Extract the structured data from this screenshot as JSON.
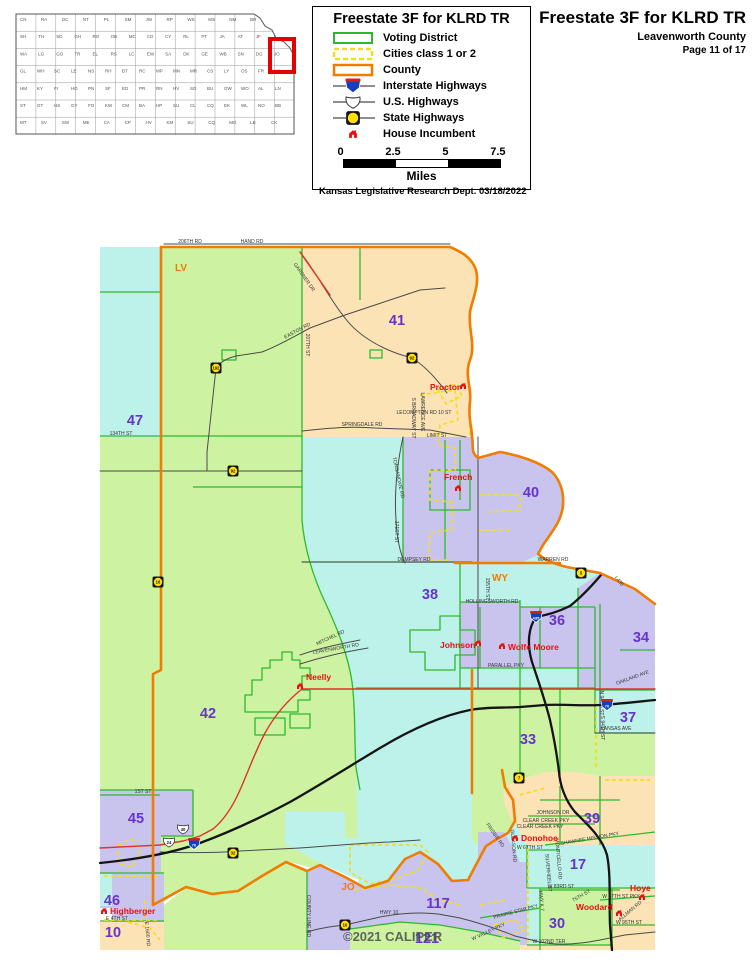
{
  "header": {
    "title": "Freestate 3F for KLRD TR",
    "county": "Leavenworth County",
    "page": "Page 11 of 17"
  },
  "legend": {
    "title": "Freestate 3F for KLRD TR",
    "items": [
      {
        "key": "voting",
        "label": "Voting District"
      },
      {
        "key": "cities",
        "label": "Cities class 1 or 2"
      },
      {
        "key": "county",
        "label": "County"
      },
      {
        "key": "interstate",
        "label": "Interstate Highways"
      },
      {
        "key": "us",
        "label": "U.S. Highways"
      },
      {
        "key": "state",
        "label": "State Highways"
      },
      {
        "key": "house",
        "label": "House Incumbent"
      }
    ],
    "scale": {
      "ticks": [
        "0",
        "2.5",
        "5",
        "7.5"
      ],
      "unit": "Miles"
    },
    "credit": "Kansas Legislative Research Dept. 03/18/2022"
  },
  "inset": {
    "name": "Kansas counties overview map",
    "highlight": "LV",
    "rows": [
      [
        "CN",
        "RA",
        "DC",
        "NT",
        "PL",
        "SM",
        "JW",
        "RP",
        "WS",
        "MS",
        "NM",
        "BR",
        "DP"
      ],
      [
        "SH",
        "TH",
        "SD",
        "GH",
        "RO",
        "OB",
        "MC",
        "CD",
        "CY",
        "RL",
        "PT",
        "JA",
        "AT",
        "JF",
        "LV"
      ],
      [
        "WA",
        "LG",
        "GO",
        "TR",
        "EL",
        "RS",
        "LC",
        "EW",
        "SA",
        "DK",
        "GE",
        "WB",
        "SN",
        "DG",
        "JO"
      ],
      [
        "GL",
        "WH",
        "SC",
        "LE",
        "NS",
        "RH",
        "BT",
        "RC",
        "MP",
        "MN",
        "MR",
        "CS",
        "LY",
        "OS",
        "FR",
        "MI"
      ],
      [
        "HM",
        "KY",
        "FI",
        "HG",
        "PN",
        "SF",
        "ED",
        "PR",
        "RN",
        "HV",
        "SG",
        "BU",
        "GW",
        "WO",
        "AL",
        "LN"
      ],
      [
        "ST",
        "GT",
        "HS",
        "GY",
        "FO",
        "KW",
        "CM",
        "BA",
        "HP",
        "SU",
        "CL",
        "CQ",
        "EK",
        "WL",
        "NO",
        "BB"
      ],
      [
        "MT",
        "SV",
        "SW",
        "ME",
        "CA",
        "CP",
        "HV",
        "KM",
        "SU",
        "CQ",
        "MG",
        "LB",
        "CK"
      ]
    ]
  },
  "map": {
    "copyright": {
      "t": "©2021 CALIPER",
      "x": 343,
      "y": 941
    },
    "county_labels": [
      {
        "t": "LV",
        "x": 181,
        "y": 271
      },
      {
        "t": "WY",
        "x": 500,
        "y": 581
      },
      {
        "t": "JO",
        "x": 348,
        "y": 890
      }
    ],
    "district_labels": [
      {
        "t": "41",
        "x": 397,
        "y": 325
      },
      {
        "t": "47",
        "x": 135,
        "y": 425
      },
      {
        "t": "40",
        "x": 531,
        "y": 497
      },
      {
        "t": "38",
        "x": 430,
        "y": 599
      },
      {
        "t": "36",
        "x": 557,
        "y": 625
      },
      {
        "t": "34",
        "x": 641,
        "y": 642
      },
      {
        "t": "37",
        "x": 628,
        "y": 722
      },
      {
        "t": "33",
        "x": 528,
        "y": 744
      },
      {
        "t": "42",
        "x": 208,
        "y": 718
      },
      {
        "t": "45",
        "x": 136,
        "y": 823
      },
      {
        "t": "39",
        "x": 592,
        "y": 823
      },
      {
        "t": "17",
        "x": 578,
        "y": 869
      },
      {
        "t": "46",
        "x": 112,
        "y": 905
      },
      {
        "t": "10",
        "x": 113,
        "y": 937
      },
      {
        "t": "30",
        "x": 557,
        "y": 928
      },
      {
        "t": "117",
        "x": 438,
        "y": 908
      },
      {
        "t": "121",
        "x": 427,
        "y": 943
      }
    ],
    "incumbents": [
      {
        "name": "Proctor",
        "x": 430,
        "y": 390,
        "hx": 463,
        "hy": 386
      },
      {
        "name": "French",
        "x": 444,
        "y": 480,
        "hx": 458,
        "hy": 488
      },
      {
        "name": "Johnson",
        "x": 440,
        "y": 648,
        "hx": 478,
        "hy": 643
      },
      {
        "name": "Wolfe Moore",
        "x": 508,
        "y": 650,
        "hx": 502,
        "hy": 646
      },
      {
        "name": "Neelly",
        "x": 306,
        "y": 680,
        "hx": 300,
        "hy": 686
      },
      {
        "name": "Highberger",
        "x": 110,
        "y": 914,
        "hx": 104,
        "hy": 911
      },
      {
        "name": "Donohoe",
        "x": 521,
        "y": 841,
        "hx": 515,
        "hy": 838
      },
      {
        "name": "Woodard",
        "x": 576,
        "y": 910,
        "hx": 619,
        "hy": 913
      },
      {
        "name": "Hoye",
        "x": 630,
        "y": 891,
        "hx": 642,
        "hy": 897
      }
    ],
    "shields": {
      "interstate": [
        {
          "n": "435",
          "x": 536,
          "y": 617
        },
        {
          "n": "70",
          "x": 607,
          "y": 705
        },
        {
          "n": "70",
          "x": 194,
          "y": 844
        }
      ],
      "us": [
        {
          "n": "40",
          "x": 183,
          "y": 829
        },
        {
          "n": "24",
          "x": 169,
          "y": 842
        }
      ],
      "state": [
        {
          "n": "192",
          "x": 216,
          "y": 368
        },
        {
          "n": "92",
          "x": 412,
          "y": 358
        },
        {
          "n": "92",
          "x": 233,
          "y": 471
        },
        {
          "n": "16",
          "x": 158,
          "y": 582
        },
        {
          "n": "5",
          "x": 581,
          "y": 573
        },
        {
          "n": "7",
          "x": 519,
          "y": 778
        },
        {
          "n": "32",
          "x": 233,
          "y": 853
        },
        {
          "n": "10",
          "x": 345,
          "y": 925
        }
      ]
    },
    "road_labels": [
      {
        "t": "206TH RD",
        "x": 190,
        "y": 243
      },
      {
        "t": "HAND RD",
        "x": 252,
        "y": 243
      },
      {
        "t": "GARDNER DR",
        "x": 303,
        "y": 278,
        "r": 55
      },
      {
        "t": "EASTON RD",
        "x": 298,
        "y": 332,
        "r": -28
      },
      {
        "t": "207TH ST",
        "x": 306,
        "y": 345,
        "r": 90
      },
      {
        "t": "SPRINGDALE RD",
        "x": 362,
        "y": 426
      },
      {
        "t": "134TH ST",
        "x": 121,
        "y": 435
      },
      {
        "t": "LECOMPTON RD 10 ST",
        "x": 424,
        "y": 414
      },
      {
        "t": "LIMIT ST",
        "x": 437,
        "y": 437
      },
      {
        "t": "S BROADWAY ST",
        "x": 412,
        "y": 418,
        "r": 90
      },
      {
        "t": "LAWRENCE AVE",
        "x": 421,
        "y": 412,
        "r": 90
      },
      {
        "t": "TONGANOXIE RD",
        "x": 397,
        "y": 478,
        "r": 78
      },
      {
        "t": "171ST ST",
        "x": 395,
        "y": 532,
        "r": 90
      },
      {
        "t": "DEMPSEY RD",
        "x": 414,
        "y": 561
      },
      {
        "t": "WARREN RD",
        "x": 553,
        "y": 561
      },
      {
        "t": "155TH ST",
        "x": 486,
        "y": 589,
        "r": 90
      },
      {
        "t": "HOLLINGSWORTH RD",
        "x": 492,
        "y": 603
      },
      {
        "t": "PARALLEL PKY",
        "x": 506,
        "y": 667
      },
      {
        "t": "OAKLAND AVE",
        "x": 633,
        "y": 679,
        "r": -20
      },
      {
        "t": "KANSAS AVE",
        "x": 616,
        "y": 730
      },
      {
        "t": "N 94TH ST",
        "x": 600,
        "y": 703,
        "r": 90
      },
      {
        "t": "S 94TH ST",
        "x": 601,
        "y": 728,
        "r": 90
      },
      {
        "t": "I 435",
        "x": 618,
        "y": 582,
        "r": 50
      },
      {
        "t": "MITCHEL RD",
        "x": 331,
        "y": 639,
        "r": -25
      },
      {
        "t": "LEAVENWORTH RD",
        "x": 336,
        "y": 650,
        "r": -10
      },
      {
        "t": "1ST ST",
        "x": 143,
        "y": 793
      },
      {
        "t": "HWY K 7",
        "x": 540,
        "y": 901,
        "r": 85
      },
      {
        "t": "MONTICELLO RD",
        "x": 557,
        "y": 859,
        "r": 85
      },
      {
        "t": "SILVERHEEL ST",
        "x": 547,
        "y": 873,
        "r": 85
      },
      {
        "t": "JOHNSON DR",
        "x": 553,
        "y": 814
      },
      {
        "t": "CLEAR CREEK PKY",
        "x": 546,
        "y": 822
      },
      {
        "t": "CLEAR CREEK PKY",
        "x": 540,
        "y": 828
      },
      {
        "t": "SHAWNEE MISSION PKY",
        "x": 590,
        "y": 840,
        "r": -10
      },
      {
        "t": "W 67TH ST",
        "x": 530,
        "y": 849
      },
      {
        "t": "FRISBIE RD",
        "x": 494,
        "y": 836,
        "r": 55
      },
      {
        "t": "GLEASON RD",
        "x": 512,
        "y": 846,
        "r": 85
      },
      {
        "t": "W 83RD ST",
        "x": 561,
        "y": 888
      },
      {
        "t": "W 87TH ST PKY",
        "x": 621,
        "y": 898
      },
      {
        "t": "75TH ST",
        "x": 582,
        "y": 897,
        "r": -30
      },
      {
        "t": "ALLMAN RD",
        "x": 631,
        "y": 912,
        "r": -40
      },
      {
        "t": "W 95TH ST",
        "x": 629,
        "y": 924
      },
      {
        "t": "PRAIRIE STAR PKY",
        "x": 516,
        "y": 913,
        "r": -15
      },
      {
        "t": "W 102ND TER",
        "x": 549,
        "y": 943
      },
      {
        "t": "HWY 10",
        "x": 389,
        "y": 914
      },
      {
        "t": "W VALLEY PKY",
        "x": 489,
        "y": 933,
        "r": -25
      },
      {
        "t": "COUNTY LINE RD",
        "x": 307,
        "y": 916,
        "r": 90
      },
      {
        "t": "E 4TH ST",
        "x": 117,
        "y": 920
      },
      {
        "t": "E 1600 RD",
        "x": 146,
        "y": 934,
        "r": 85
      }
    ]
  },
  "colors": {
    "county_line": "#F07C00",
    "district_line": "#2EB82E",
    "city_line": "#F2DE1F",
    "district_fill_cyan": "#BCF2EA",
    "district_fill_green": "#CDF3A2",
    "district_fill_tan": "#FBE3B5",
    "district_fill_purple": "#C9C4EE",
    "district_number": "#6633CC",
    "incumbent_red": "#E8100C",
    "road_gray": "#4A4A4A",
    "us_highway_red": "#E03228",
    "interstate_black": "#141414",
    "inset_highlight_red": "#E80000"
  }
}
